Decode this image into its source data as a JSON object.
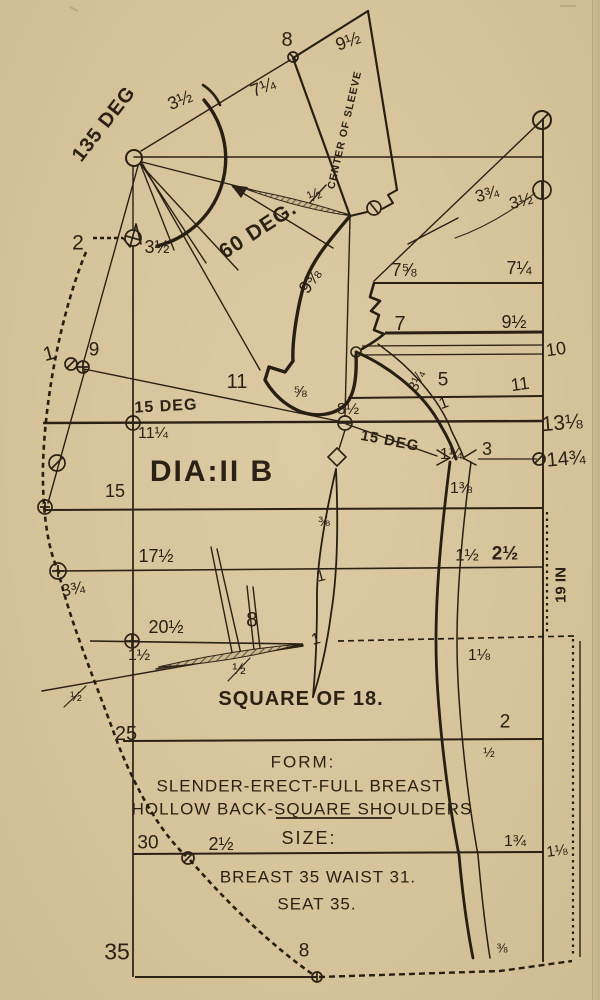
{
  "colors": {
    "paper": "#d8c59d",
    "ink": "#2b2114",
    "ink_heavy": "#271f12"
  },
  "diagram": {
    "id_label": "DIA:II B",
    "square_label": "SQUARE OF 18.",
    "sleeve_axis_label": "CENTER OF SLEEVE",
    "angle_labels": [
      "135 DEG",
      "60 DEG.",
      "15 DEG",
      "15 DEG"
    ],
    "form": {
      "heading": "FORM:",
      "line1": "SLENDER-ERECT-FULL BREAST",
      "line2": "HOLLOW BACK-SQUARE SHOULDERS"
    },
    "size": {
      "heading": "SIZE:",
      "breast_waist": "BREAST 35 WAIST 31.",
      "seat": "SEAT 35."
    },
    "side_note": "19 IN",
    "labels": [
      {
        "name": "angle-135-deg",
        "text": "135 DEG",
        "x": 104,
        "y": 124,
        "rot": -52,
        "size": 20,
        "bold": true,
        "ls": 1
      },
      {
        "name": "meas-8-top",
        "text": "8",
        "x": 287,
        "y": 40,
        "rot": 0,
        "size": 20
      },
      {
        "name": "meas-3half-shoulder",
        "text": "3½",
        "x": 180,
        "y": 100,
        "rot": -22,
        "size": 18
      },
      {
        "name": "meas-7quarter-sleeve",
        "text": "7¼",
        "x": 263,
        "y": 87,
        "rot": -22,
        "size": 18
      },
      {
        "name": "meas-9half-sleeve",
        "text": "9½",
        "x": 348,
        "y": 41,
        "rot": -20,
        "size": 18
      },
      {
        "name": "sleeve-axis",
        "text": "CENTER OF SLEEVE",
        "x": 345,
        "y": 130,
        "rot": -77,
        "size": 10.5,
        "bold": true,
        "ls": 1
      },
      {
        "name": "meas-half-sleeve",
        "text": "½",
        "x": 315,
        "y": 196,
        "rot": -25,
        "size": 16
      },
      {
        "name": "angle-60-deg",
        "text": "60 DEG.",
        "x": 258,
        "y": 230,
        "rot": -33,
        "size": 21,
        "bold": true,
        "ls": 1
      },
      {
        "name": "meas-2-topleft",
        "text": "2",
        "x": 78,
        "y": 243,
        "rot": 0,
        "size": 21
      },
      {
        "name": "meas-3half-notch",
        "text": "3½",
        "x": 157,
        "y": 247,
        "rot": 0,
        "size": 18
      },
      {
        "name": "meas-3threequarter-right",
        "text": "3¾",
        "x": 487,
        "y": 194,
        "rot": -15,
        "size": 17
      },
      {
        "name": "meas-3half-right",
        "text": "3½",
        "x": 521,
        "y": 201,
        "rot": -15,
        "size": 17
      },
      {
        "name": "meas-7fiveeighths",
        "text": "7⅝",
        "x": 404,
        "y": 270,
        "rot": 0,
        "size": 18
      },
      {
        "name": "meas-7quarter-right",
        "text": "7¼",
        "x": 519,
        "y": 268,
        "rot": 0,
        "size": 18
      },
      {
        "name": "meas-7",
        "text": "7",
        "x": 400,
        "y": 324,
        "rot": 0,
        "size": 20
      },
      {
        "name": "meas-9half-right",
        "text": "9½",
        "x": 514,
        "y": 322,
        "rot": 0,
        "size": 18
      },
      {
        "name": "meas-10",
        "text": "10",
        "x": 556,
        "y": 349,
        "rot": -8,
        "size": 18
      },
      {
        "name": "meas-9threeeighths",
        "text": "9⅜",
        "x": 310,
        "y": 281,
        "rot": -55,
        "size": 18
      },
      {
        "name": "meas-1-left",
        "text": "1",
        "x": 49,
        "y": 354,
        "rot": -15,
        "size": 20
      },
      {
        "name": "meas-9-left",
        "text": "9",
        "x": 94,
        "y": 350,
        "rot": 0,
        "size": 19
      },
      {
        "name": "meas-11-notch",
        "text": "11",
        "x": 237,
        "y": 382,
        "rot": 0,
        "size": 20
      },
      {
        "name": "meas-3quarter-scye",
        "text": "3¼",
        "x": 417,
        "y": 381,
        "rot": -65,
        "size": 15
      },
      {
        "name": "meas-5",
        "text": "5",
        "x": 443,
        "y": 380,
        "rot": 0,
        "size": 19
      },
      {
        "name": "meas-11-right",
        "text": "11",
        "x": 520,
        "y": 384,
        "rot": -8,
        "size": 18
      },
      {
        "name": "meas-fiveeighths",
        "text": "⅝",
        "x": 300,
        "y": 393,
        "rot": 0,
        "size": 16
      },
      {
        "name": "meas-8half",
        "text": "8½",
        "x": 348,
        "y": 410,
        "rot": 0,
        "size": 16
      },
      {
        "name": "angle-15-deg-left",
        "text": "15 DEG",
        "x": 166,
        "y": 407,
        "rot": -3,
        "size": 16,
        "bold": true,
        "ls": 1
      },
      {
        "name": "meas-11quarter",
        "text": "11¼",
        "x": 153,
        "y": 434,
        "rot": 0,
        "size": 16
      },
      {
        "name": "meas-13oneeighth",
        "text": "13⅛",
        "x": 562,
        "y": 423,
        "rot": -5,
        "size": 21
      },
      {
        "name": "angle-15-deg-right",
        "text": "15 DEG",
        "x": 390,
        "y": 441,
        "rot": 11,
        "size": 15,
        "bold": true,
        "ls": 1
      },
      {
        "name": "meas-1-scye",
        "text": "1",
        "x": 444,
        "y": 404,
        "rot": -20,
        "size": 16
      },
      {
        "name": "meas-1quarter",
        "text": "1¼",
        "x": 451,
        "y": 455,
        "rot": 0,
        "size": 16
      },
      {
        "name": "meas-3",
        "text": "3",
        "x": 487,
        "y": 449,
        "rot": 0,
        "size": 18
      },
      {
        "name": "meas-14threequarter",
        "text": "14¾",
        "x": 566,
        "y": 459,
        "rot": -5,
        "size": 20
      },
      {
        "name": "meas-1threeeighths",
        "text": "1⅜",
        "x": 461,
        "y": 489,
        "rot": 0,
        "size": 16
      },
      {
        "name": "diagram-id",
        "text": "DIA:II B",
        "x": 212,
        "y": 472,
        "rot": 0,
        "size": 30,
        "bold": true,
        "ls": 2
      },
      {
        "name": "meas-15",
        "text": "15",
        "x": 115,
        "y": 491,
        "rot": 0,
        "size": 18
      },
      {
        "name": "meas-threeeighths-dart",
        "text": "⅜",
        "x": 324,
        "y": 521,
        "rot": 0,
        "size": 14
      },
      {
        "name": "meas-17half",
        "text": "17½",
        "x": 156,
        "y": 556,
        "rot": 0,
        "size": 18
      },
      {
        "name": "meas-1half-right",
        "text": "1½",
        "x": 467,
        "y": 555,
        "rot": 0,
        "size": 17
      },
      {
        "name": "meas-2half-right",
        "text": "2½",
        "x": 505,
        "y": 554,
        "rot": 0,
        "size": 19,
        "bold": true
      },
      {
        "name": "note-19-in",
        "text": "19 IN",
        "x": 561,
        "y": 585,
        "rot": -90,
        "size": 15,
        "bold": true
      },
      {
        "name": "meas-3threequarter-left",
        "text": "3¾",
        "x": 73,
        "y": 589,
        "rot": -10,
        "size": 17
      },
      {
        "name": "meas-20half",
        "text": "20½",
        "x": 166,
        "y": 627,
        "rot": 0,
        "size": 18
      },
      {
        "name": "meas-8-mid",
        "text": "8",
        "x": 252,
        "y": 620,
        "rot": 0,
        "size": 21
      },
      {
        "name": "meas-1half-left",
        "text": "1½",
        "x": 139,
        "y": 656,
        "rot": 0,
        "size": 16
      },
      {
        "name": "meas-1-dart-a",
        "text": "1",
        "x": 321,
        "y": 577,
        "rot": -15,
        "size": 16
      },
      {
        "name": "meas-1-dart-b",
        "text": "1",
        "x": 316,
        "y": 640,
        "rot": -15,
        "size": 16
      },
      {
        "name": "meas-half-dart",
        "text": "½",
        "x": 239,
        "y": 670,
        "rot": 0,
        "size": 16
      },
      {
        "name": "meas-half-left",
        "text": "½",
        "x": 76,
        "y": 696,
        "rot": 0,
        "size": 14
      },
      {
        "name": "meas-1oneeighth-mid",
        "text": "1⅛",
        "x": 479,
        "y": 656,
        "rot": 0,
        "size": 16
      },
      {
        "name": "square-of-18",
        "text": "SQUARE OF 18.",
        "x": 301,
        "y": 699,
        "rot": 0,
        "size": 20,
        "bold": true,
        "ls": 1
      },
      {
        "name": "meas-25",
        "text": "25",
        "x": 126,
        "y": 734,
        "rot": 0,
        "size": 20
      },
      {
        "name": "meas-2-right",
        "text": "2",
        "x": 505,
        "y": 722,
        "rot": 0,
        "size": 19
      },
      {
        "name": "meas-half-right",
        "text": "½",
        "x": 489,
        "y": 752,
        "rot": 0,
        "size": 14
      },
      {
        "name": "form-heading",
        "text": "FORM:",
        "x": 303,
        "y": 762,
        "rot": 0,
        "size": 17,
        "ls": 2
      },
      {
        "name": "form-line-1",
        "text": "SLENDER-ERECT-FULL BREAST",
        "x": 300,
        "y": 786,
        "rot": 0,
        "size": 17,
        "ls": 1
      },
      {
        "name": "form-line-2",
        "text": "HOLLOW BACK-SQUARE SHOULDERS",
        "x": 302,
        "y": 809,
        "rot": 0,
        "size": 17,
        "ls": 1
      },
      {
        "name": "size-heading",
        "text": "SIZE:",
        "x": 309,
        "y": 838,
        "rot": 0,
        "size": 18,
        "ls": 2
      },
      {
        "name": "meas-30",
        "text": "30",
        "x": 148,
        "y": 843,
        "rot": 0,
        "size": 19
      },
      {
        "name": "meas-2half-bottom",
        "text": "2½",
        "x": 221,
        "y": 844,
        "rot": 0,
        "size": 18
      },
      {
        "name": "size-line-1",
        "text": "BREAST 35 WAIST 31.",
        "x": 318,
        "y": 877,
        "rot": 0,
        "size": 17,
        "ls": 1
      },
      {
        "name": "size-line-2",
        "text": "SEAT 35.",
        "x": 317,
        "y": 904,
        "rot": 0,
        "size": 17,
        "ls": 1
      },
      {
        "name": "meas-35",
        "text": "35",
        "x": 117,
        "y": 952,
        "rot": 0,
        "size": 23
      },
      {
        "name": "meas-8-bottom",
        "text": "8",
        "x": 304,
        "y": 951,
        "rot": 0,
        "size": 19
      },
      {
        "name": "meas-1threequarter-bottom",
        "text": "1¾",
        "x": 515,
        "y": 842,
        "rot": 0,
        "size": 16
      },
      {
        "name": "meas-1oneeighth-right",
        "text": "1⅛",
        "x": 557,
        "y": 851,
        "rot": -8,
        "size": 15
      },
      {
        "name": "meas-threeeighths-bottom",
        "text": "⅜",
        "x": 502,
        "y": 948,
        "rot": 0,
        "size": 13
      }
    ]
  }
}
